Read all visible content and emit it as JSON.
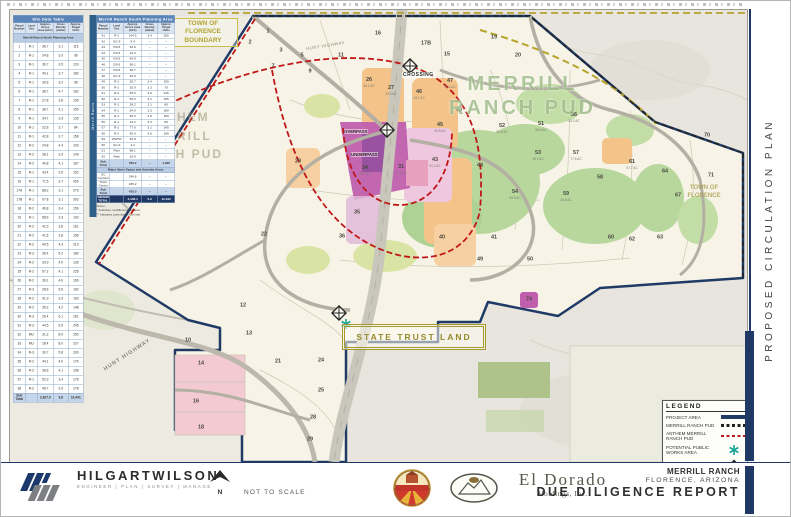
{
  "rail": {
    "title": "PROPOSED CIRCULATION PLAN"
  },
  "titleblock": {
    "project": "MERRILL RANCH",
    "location": "FLORENCE, ARIZONA",
    "report": "DUE DILIGENCE REPORT"
  },
  "firm": {
    "name": "HILGARTWILSON",
    "tagline": "ENGINEER | PLAN | SURVEY | MANAGE",
    "address": [
      "2141 E. HIGHLAND AVE., STE. 250",
      "PHOENIX, AZ 85016",
      "P: 602.490.0535"
    ],
    "project_info": [
      "PROJECT MANAGER",
      "PROJECT NUMBER: 1505"
    ],
    "scale_note": "NOT TO SCALE",
    "north": "N"
  },
  "partners": {
    "town_seal": "TOWN OF FLORENCE",
    "eldorado_name": "El Dorado",
    "eldorado_sub": "Holdings, Inc."
  },
  "legend": {
    "title": "LEGEND",
    "items": [
      "Project Area",
      "Merrill Ranch PUD",
      "Anthem Merrill Ranch PUD",
      "Potential Public Works Area",
      "Potential T.I."
    ]
  },
  "map": {
    "labels": {
      "merrill_pud": "MERRILL RANCH PUD",
      "anthem_pud": "ANTHEM MERRILL RANCH PUD",
      "state_trust": "STATE TRUST LAND",
      "tof_boundary": "TOWN OF FLORENCE BOUNDARY",
      "tof_right": "TOWN OF FLORENCE",
      "crossing": "CROSSING",
      "overpass": "OVERPASS",
      "underpass": "UNDERPASS",
      "hunt_hwy": "HUNT HIGHWAY",
      "hunt_hwy_top": "HUNT HIGHWAY"
    },
    "parcels": [
      {
        "n": "1",
        "x": 258,
        "y": 22
      },
      {
        "n": "2",
        "x": 240,
        "y": 33
      },
      {
        "n": "3",
        "x": 271,
        "y": 41
      },
      {
        "n": "5",
        "x": 292,
        "y": 46
      },
      {
        "n": "7",
        "x": 263,
        "y": 57
      },
      {
        "n": "9",
        "x": 300,
        "y": 62
      },
      {
        "n": "11",
        "x": 331,
        "y": 46
      },
      {
        "n": "15",
        "x": 437,
        "y": 45
      },
      {
        "n": "16",
        "x": 368,
        "y": 24
      },
      {
        "n": "17B",
        "x": 416,
        "y": 34
      },
      {
        "n": "19",
        "x": 484,
        "y": 28
      },
      {
        "n": "20",
        "x": 508,
        "y": 46
      },
      {
        "n": "26",
        "x": 359,
        "y": 73,
        "sub": "36.1 AC"
      },
      {
        "n": "27",
        "x": 381,
        "y": 81,
        "sub": "28.6 AC"
      },
      {
        "n": "46",
        "x": 409,
        "y": 85,
        "sub": "43.1 AC"
      },
      {
        "n": "47",
        "x": 440,
        "y": 74,
        "sub": "57.6 AC"
      },
      {
        "n": "48",
        "x": 449,
        "y": 101
      },
      {
        "n": "45",
        "x": 430,
        "y": 118,
        "sub": "59.8 AC"
      },
      {
        "n": "43",
        "x": 425,
        "y": 153,
        "sub": "51.2 AC"
      },
      {
        "n": "34",
        "x": 355,
        "y": 161,
        "sub": "39.7 AC"
      },
      {
        "n": "31",
        "x": 391,
        "y": 160,
        "sub": "44.5 AC"
      },
      {
        "n": "40",
        "x": 432,
        "y": 228
      },
      {
        "n": "41",
        "x": 484,
        "y": 228
      },
      {
        "n": "51",
        "x": 531,
        "y": 117,
        "sub": "55.6 AC"
      },
      {
        "n": "52",
        "x": 492,
        "y": 119,
        "sub": "50.6 AC"
      },
      {
        "n": "53",
        "x": 528,
        "y": 146,
        "sub": "28.2 AC"
      },
      {
        "n": "54",
        "x": 505,
        "y": 185,
        "sub": "54.9 AC"
      },
      {
        "n": "56",
        "x": 564,
        "y": 108,
        "sub": "24.2 AC"
      },
      {
        "n": "57",
        "x": 566,
        "y": 146,
        "sub": "77.6 AC"
      },
      {
        "n": "58",
        "x": 590,
        "y": 168
      },
      {
        "n": "59",
        "x": 556,
        "y": 187,
        "sub": "40.8 AC"
      },
      {
        "n": "60",
        "x": 601,
        "y": 228
      },
      {
        "n": "61",
        "x": 622,
        "y": 155,
        "sub": "57.7 AC"
      },
      {
        "n": "62",
        "x": 622,
        "y": 230
      },
      {
        "n": "63",
        "x": 650,
        "y": 228
      },
      {
        "n": "64",
        "x": 655,
        "y": 162
      },
      {
        "n": "67",
        "x": 668,
        "y": 186
      },
      {
        "n": "70",
        "x": 697,
        "y": 126
      },
      {
        "n": "71",
        "x": 701,
        "y": 166
      },
      {
        "n": "74",
        "x": 519,
        "y": 290
      },
      {
        "n": "12",
        "x": 233,
        "y": 296
      },
      {
        "n": "13",
        "x": 239,
        "y": 324
      },
      {
        "n": "21",
        "x": 268,
        "y": 352
      },
      {
        "n": "24",
        "x": 311,
        "y": 351
      },
      {
        "n": "25",
        "x": 311,
        "y": 381
      },
      {
        "n": "28",
        "x": 303,
        "y": 408
      },
      {
        "n": "29",
        "x": 300,
        "y": 430
      },
      {
        "n": "14",
        "x": 191,
        "y": 354
      },
      {
        "n": "16",
        "x": 186,
        "y": 392
      },
      {
        "n": "18",
        "x": 191,
        "y": 418
      },
      {
        "n": "10",
        "x": 178,
        "y": 331
      },
      {
        "n": "22",
        "x": 254,
        "y": 225
      },
      {
        "n": "23",
        "x": 288,
        "y": 152
      },
      {
        "n": "35",
        "x": 347,
        "y": 203
      },
      {
        "n": "36",
        "x": 332,
        "y": 227
      },
      {
        "n": "44",
        "x": 470,
        "y": 156
      },
      {
        "n": "49",
        "x": 470,
        "y": 250
      },
      {
        "n": "50",
        "x": 520,
        "y": 250
      }
    ]
  },
  "tables": {
    "columns": [
      "Parcel Number",
      "Land Use",
      "Approx. Gross Area (AC±)",
      "Gross Density (du/ac)",
      "Approx. Target Units"
    ],
    "site": {
      "title": "Site Data Table",
      "section": "Merrill Ranch North Planning Area",
      "rows": [
        [
          "1",
          "R-1",
          "36.7",
          "3.1",
          "115"
        ],
        [
          "2",
          "R-1",
          "24.8",
          "3.9",
          "96"
        ],
        [
          "3",
          "R-1",
          "36.7",
          "3.5",
          "129"
        ],
        [
          "4",
          "R-1",
          "49.1",
          "3.7",
          "180"
        ],
        [
          "5",
          "R-1",
          "30.6",
          "3.2",
          "98"
        ],
        [
          "6",
          "R-1",
          "38.7",
          "4.7",
          "182"
        ],
        [
          "7",
          "R-1",
          "27.8",
          "3.8",
          "106"
        ],
        [
          "8",
          "R-1",
          "38.7",
          "4.1",
          "159"
        ],
        [
          "9",
          "R-1",
          "34.7",
          "3.9",
          "135"
        ],
        [
          "10",
          "R-1",
          "22.8",
          "3.7",
          "84"
        ],
        [
          "11",
          "R-1",
          "42.8",
          "3.7",
          "158"
        ],
        [
          "12",
          "R-2",
          "24.8",
          "4.4",
          "109"
        ],
        [
          "13",
          "R-2",
          "38.1",
          "3.9",
          "149"
        ],
        [
          "14",
          "R-2",
          "40.8",
          "4.1",
          "167"
        ],
        [
          "15",
          "R-1",
          "43.4",
          "3.5",
          "152"
        ],
        [
          "16",
          "R-1",
          "71.5",
          "3.7",
          "265"
        ],
        [
          "17A",
          "R-1",
          "88.2",
          "3.1",
          "273"
        ],
        [
          "17B",
          "R-1",
          "97.8",
          "3.1",
          "303"
        ],
        [
          "18",
          "R-2",
          "46.8",
          "3.4",
          "159"
        ],
        [
          "19",
          "R-1",
          "58.6",
          "3.3",
          "193"
        ],
        [
          "20",
          "R-2",
          "42.3",
          "3.8",
          "161"
        ],
        [
          "21",
          "R-2",
          "41.6",
          "3.8",
          "158"
        ],
        [
          "22",
          "R-2",
          "49.5",
          "4.3",
          "213"
        ],
        [
          "23",
          "R-3",
          "36.4",
          "5.2",
          "189"
        ],
        [
          "24",
          "R-2",
          "33.9",
          "4.0",
          "136"
        ],
        [
          "25",
          "R-2",
          "57.2",
          "4.1",
          "235"
        ],
        [
          "26",
          "R-2",
          "36.1",
          "4.6",
          "166"
        ],
        [
          "27",
          "R-3",
          "28.6",
          "5.6",
          "160"
        ],
        [
          "28",
          "R-2",
          "41.9",
          "3.9",
          "163"
        ],
        [
          "29",
          "R-2",
          "35.2",
          "4.2",
          "148"
        ],
        [
          "30",
          "R-3",
          "26.4",
          "6.1",
          "161"
        ],
        [
          "31",
          "R-3",
          "44.5",
          "5.5",
          "245"
        ],
        [
          "32",
          "MU",
          "31.2",
          "8.0",
          "250"
        ],
        [
          "33",
          "MU",
          "28.4",
          "8.0",
          "227"
        ],
        [
          "34",
          "R-3",
          "39.7",
          "5.8",
          "230"
        ],
        [
          "35",
          "R-2",
          "44.1",
          "4.0",
          "176"
        ],
        [
          "36",
          "R-2",
          "38.6",
          "4.1",
          "158"
        ],
        [
          "37",
          "R-1",
          "52.3",
          "3.4",
          "178"
        ],
        [
          "38",
          "R-2",
          "45.7",
          "3.9",
          "178"
        ],
        [
          "Sub Total",
          "",
          "2,927.9",
          "3.6",
          "10,441"
        ]
      ]
    },
    "south": {
      "title": "Merrill Ranch South Planning Area",
      "sidebar": "Merrill Ranch",
      "rows": [
        [
          "41",
          "R-1",
          "104.5",
          "3.4",
          "355"
        ],
        [
          "42",
          "GC-9",
          "9.4",
          "--",
          "--"
        ],
        [
          "43",
          "OS-5",
          "52.6",
          "--",
          "--"
        ],
        [
          "44",
          "OS-5",
          "23.4",
          "--",
          "--"
        ],
        [
          "45",
          "OS-5",
          "64.0",
          "--",
          "--"
        ],
        [
          "46",
          "OS-5",
          "58.1",
          "--",
          "--"
        ],
        [
          "47",
          "OS-5",
          "48.7",
          "--",
          "--"
        ],
        [
          "48",
          "GC-9",
          "45.9",
          "--",
          "--"
        ],
        [
          "49",
          "R-1",
          "55.7",
          "3.4",
          "190"
        ],
        [
          "50",
          "R-1",
          "20.9",
          "3.3",
          "70"
        ],
        [
          "51",
          "R-1",
          "55.6",
          "3.9",
          "215"
        ],
        [
          "52",
          "R-1",
          "50.6",
          "3.1",
          "155"
        ],
        [
          "53",
          "R-1",
          "28.2",
          "3.1",
          "85"
        ],
        [
          "54",
          "R-1",
          "54.9",
          "3.3",
          "180"
        ],
        [
          "55",
          "R-1",
          "50.6",
          "3.0",
          "150"
        ],
        [
          "56",
          "R-1",
          "24.2",
          "3.3",
          "80"
        ],
        [
          "57",
          "R-1",
          "77.6",
          "3.1",
          "240"
        ],
        [
          "58",
          "R-2",
          "50.6",
          "3.6",
          "180"
        ],
        [
          "59",
          "WWTP",
          "40.8",
          "--",
          "--"
        ],
        [
          "60",
          "GC-9",
          "4.4",
          "--",
          "--"
        ],
        [
          "61",
          "Park",
          "88.1",
          "--",
          "--"
        ],
        [
          "62",
          "Park",
          "20.9",
          "--",
          "--"
        ],
        [
          "Sub Total",
          "",
          "785.2",
          "--",
          "1,900"
        ]
      ],
      "amenity_title": "Major Open Space and Amenity Areas",
      "amenity_rows": [
        [
          "GC Corridor",
          "",
          "249.8",
          "--",
          "--"
        ],
        [
          "Town Center",
          "",
          "185.2",
          "--",
          "--"
        ],
        [
          "Sub Total",
          "",
          "435.0",
          "--",
          "--"
        ],
        [
          "GRAND TOTAL",
          "",
          "4,148.1",
          "5.2",
          "12,341"
        ]
      ],
      "notes": [
        "Notes:",
        "* Indicates modified parcel area",
        "** Indicates potential school site"
      ]
    }
  }
}
